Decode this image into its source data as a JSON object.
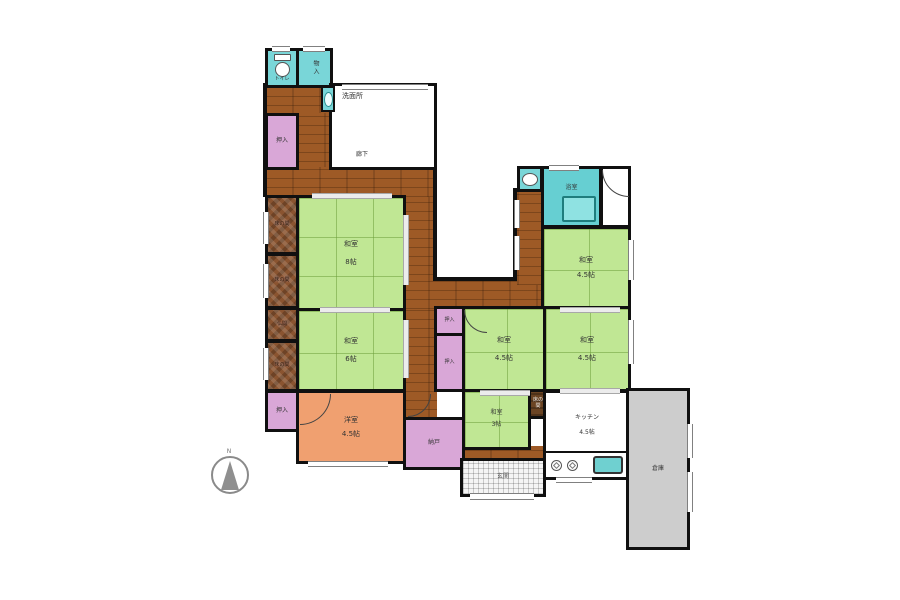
{
  "compass": {
    "north": "N"
  },
  "labels": {
    "toilet": "トイレ",
    "storage": "物入",
    "washroom": "洗面所",
    "hallway": "廊下",
    "closet": "押入",
    "alcove": "床の間",
    "altar_room": "仏間",
    "storeroom": "納戸",
    "entrance": "玄関",
    "bathroom": "浴室",
    "warehouse": "倉庫"
  },
  "rooms": {
    "washitsu_8": {
      "name": "和室",
      "size": "8帖"
    },
    "washitsu_6": {
      "name": "和室",
      "size": "6帖"
    },
    "washitsu_45": {
      "name": "和室",
      "size": "4.5帖"
    },
    "washitsu_3": {
      "name": "和室",
      "size": "3帖"
    },
    "youshitsu": {
      "name": "洋室",
      "size": "4.5帖"
    },
    "kitchen": {
      "name": "キッチン",
      "size": "4.5帖"
    }
  },
  "colors": {
    "tatami_green": "#c0e794",
    "corridor_wood": "#9e5a26",
    "closet_pink": "#d9a7d7",
    "fixture_teal": "#79d6d8",
    "western_orange": "#f0a070",
    "warehouse_gray": "#cdcdcd",
    "wall_black": "#101010"
  }
}
